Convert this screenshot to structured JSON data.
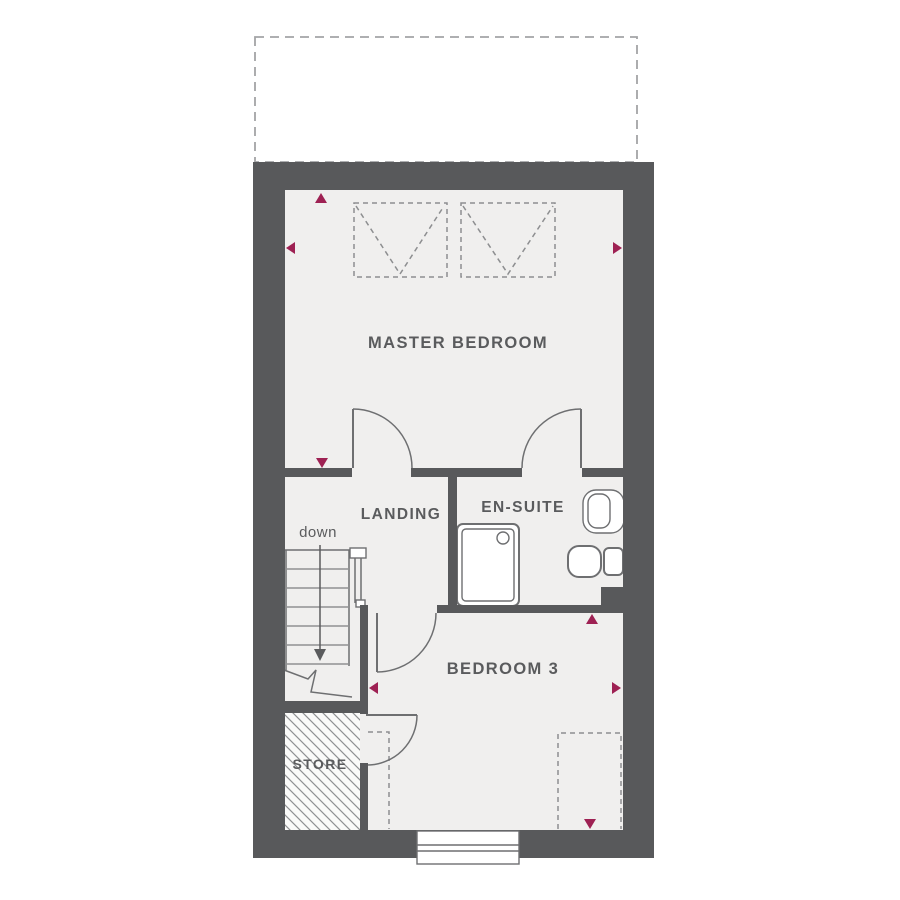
{
  "plan": {
    "rooms": [
      {
        "id": "master-bedroom",
        "label": "MASTER BEDROOM"
      },
      {
        "id": "landing",
        "label": "LANDING"
      },
      {
        "id": "en-suite",
        "label": "EN-SUITE"
      },
      {
        "id": "bedroom-3",
        "label": "BEDROOM 3"
      },
      {
        "id": "store",
        "label": "STORE"
      }
    ],
    "stairs": {
      "direction_label": "down"
    },
    "colors": {
      "wall": "#58595b",
      "floor": "#f0efee",
      "store_floor": "#fafaf9",
      "fixture_line": "#6e6f71",
      "stair_line": "#8f9092",
      "dashed_line": "#8d8e90",
      "outline_dashed": "#a3a4a6",
      "marker": "#9e2153",
      "label_text": "#5a5b5d"
    }
  }
}
